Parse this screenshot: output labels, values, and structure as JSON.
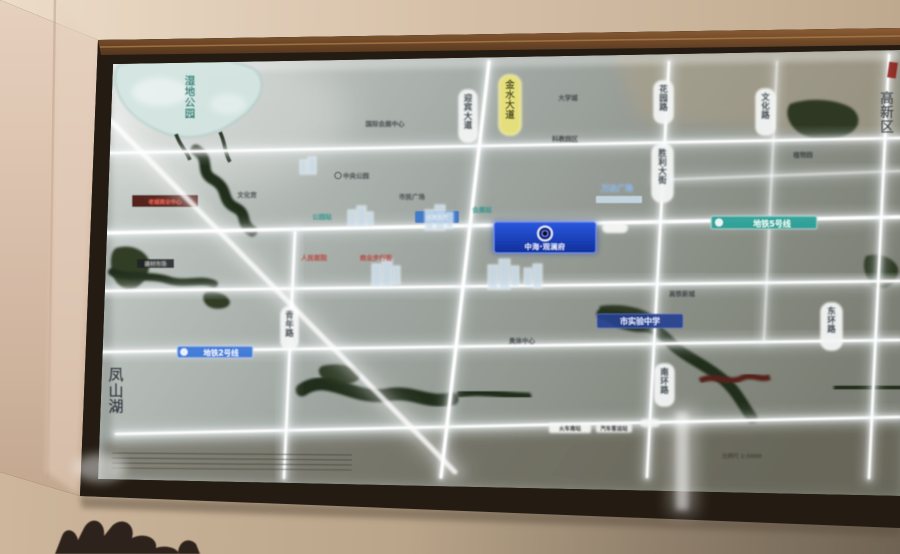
{
  "photo": {
    "subject": "Illuminated real-estate location map lightbox on a wall, photographed at an angle with glass glare",
    "colors": {
      "wall": "#dcc6b2",
      "frame": "#241c13",
      "wood_trim": "#8a5c34",
      "panel_base": "#9aa29e",
      "road_glow": "#ffffff",
      "water_green": "#26301d",
      "metro_teal": "#2aa198",
      "metro_blue": "#3b79d8",
      "sign_blue": "#1a46c8",
      "plate_yellow": "#e9e27a"
    }
  },
  "map": {
    "district_vertical_label": "凤山湖",
    "lake": {
      "name": "湿地公园"
    },
    "project_sign": {
      "name": "中海·观澜府"
    },
    "metro": {
      "line5": {
        "label": "地铁5号线"
      },
      "line2": {
        "label": "地铁2号线"
      }
    },
    "school_board": {
      "label": "市实验中学"
    },
    "bars": {
      "red_bar": {
        "label": "老城商业中心"
      },
      "dark_bar": {
        "label": "建材市场"
      },
      "blue_chip": {
        "label": "城市展厅"
      },
      "mall_glow": {
        "label": "万达广场"
      }
    },
    "road_plates": {
      "binhe": "滨河路",
      "qingnian": "青年路",
      "yingbin": "迎宾大道",
      "jinshui": "金水大道",
      "huayuan": "花园路",
      "shengli": "胜利大街",
      "nanhuan": "南环路",
      "wenhua": "文化路",
      "donghuan": "东环路",
      "district_edge": "高新区"
    },
    "stations": [
      "公园站",
      "会展站"
    ],
    "poi": [
      "国际会展中心",
      "中央公园",
      "市民广场",
      "文化宫",
      "大学城",
      "科教园区",
      "高铁新城",
      "奥体中心",
      "植物园",
      "人民医院",
      "商业步行街"
    ],
    "small_plates": {
      "rail_station": "火车南站",
      "bus_station": "汽车客运站"
    },
    "legend_note": "比例尺 1:5000"
  }
}
